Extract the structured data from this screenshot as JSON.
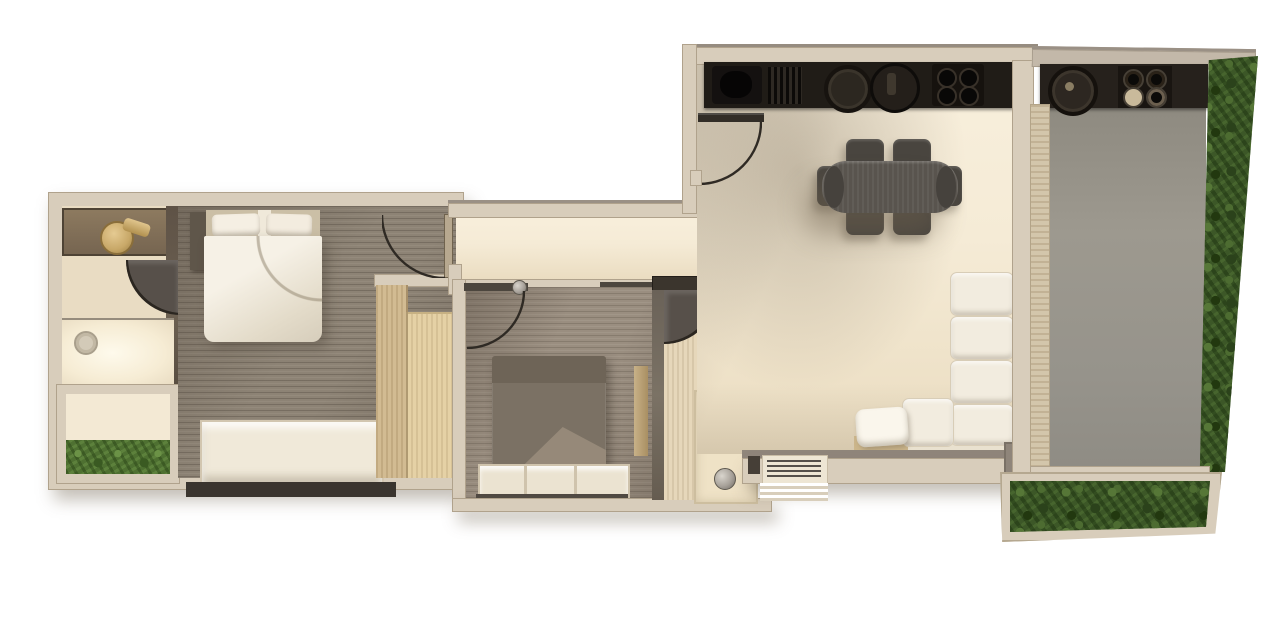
{
  "scene": {
    "type": "apartment-floor-plan",
    "style": "top-down-3d-render",
    "background": "#ffffff",
    "rooms": [
      {
        "id": "bathroom-1",
        "area": "left-wing",
        "fixtures": [
          "vanity-gold-basin",
          "gold-tap",
          "walk-in-shower",
          "shower-drain",
          "swing-door"
        ]
      },
      {
        "id": "balcony-planter",
        "area": "left-wing",
        "fixtures": [
          "hedge-strip"
        ]
      },
      {
        "id": "master-bedroom",
        "area": "left-wing",
        "fixtures": [
          "double-bed",
          "headboard",
          "pillows",
          "side-unit",
          "dresser",
          "wardrobe",
          "swing-door"
        ]
      },
      {
        "id": "hallway",
        "area": "center",
        "fixtures": [
          "sliding-rail"
        ]
      },
      {
        "id": "bedroom-2",
        "area": "center",
        "fixtures": [
          "double-bed",
          "storage-bench",
          "wardrobe",
          "shelf-strip",
          "swing-door"
        ]
      },
      {
        "id": "bathroom-2",
        "area": "center",
        "fixtures": [
          "wall-hung-toilet",
          "shower-tray",
          "shower-drain",
          "swing-door"
        ]
      },
      {
        "id": "kitchen-living-dining",
        "area": "right-wing",
        "fixtures": [
          "kitchen-counter",
          "sink",
          "drainboard",
          "round-plate",
          "pot",
          "four-burner-hob",
          "entrance-door",
          "dining-table",
          "six-dining-chairs",
          "corner-sofa",
          "throw-pillow",
          "coat-hook-panel",
          "louver-vent",
          "exterior-steps"
        ]
      },
      {
        "id": "terrace",
        "area": "right-wing",
        "fixtures": [
          "outdoor-counter",
          "outdoor-burner",
          "outdoor-hob",
          "sliding-door-track",
          "gray-deck",
          "hedge-wall",
          "planter-box"
        ]
      }
    ]
  },
  "palette": {
    "wall": "#d8cdbb",
    "walledge": "#b0a28c",
    "walldark": "#3b352d",
    "cream": "#f5ebd6",
    "creamshade": "#ddd0b5",
    "wood1": "#8d8375",
    "wood2": "#9a8e80",
    "bathfloor": "#e9dcc3",
    "grainv": "#e6d7ba",
    "closet1": "#d2bb92",
    "closet2": "#e5d1a5",
    "terrace": "#97938a",
    "counter": "#201c17",
    "hedge": "#3c5727",
    "hedgelight": "#567737",
    "planter": "#4e7031",
    "table": "#59544e",
    "chair": "#49453f",
    "bed2": "#7b7164",
    "bed2head": "#6e6457",
    "bed2fold": "#988b7b",
    "white": "#f2ecdf",
    "gold": "#c8a868",
    "metal": "#a8a29a",
    "door": "#57504a",
    "arc": "#2f2a24",
    "shadow": "rgba(125,112,96,0.45)"
  }
}
